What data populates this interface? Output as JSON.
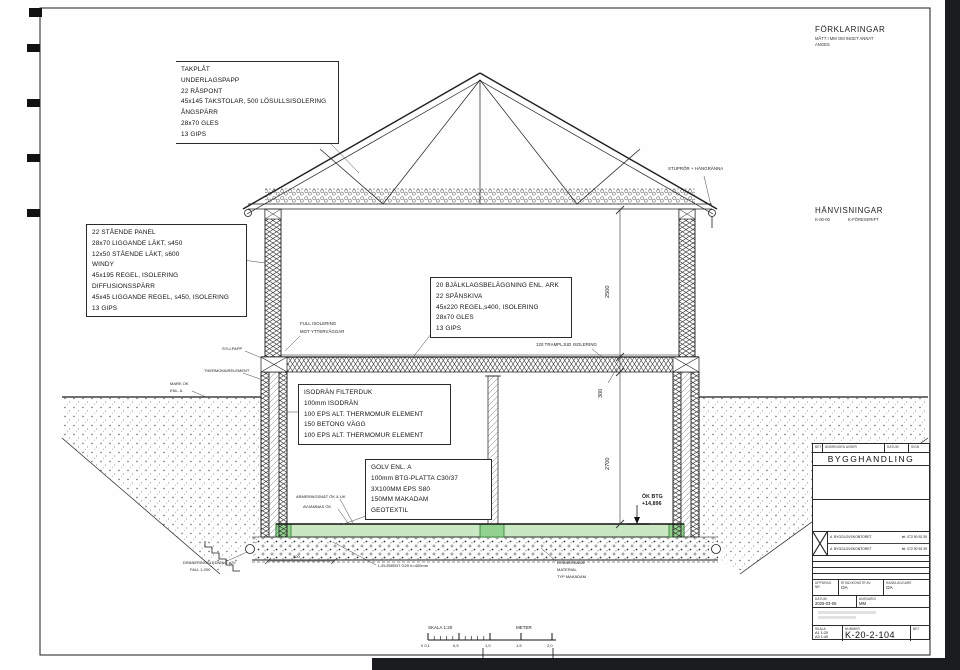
{
  "sheet": {
    "bg": "#fefefe",
    "frame_color": "#1d1d1d",
    "outside_color": "#1b1c20",
    "slab_green": "#c9e7c2",
    "slab_green_dark": "#93d18e"
  },
  "legend": {
    "title": "FÖRKLARINGAR",
    "notes": [
      "MÅTT I MM OM INGET ANNAT",
      "ANGES"
    ]
  },
  "references": {
    "title": "HÄNVISNINGAR",
    "code": "K-00-00",
    "doc": "K-FÖRESKRIFT"
  },
  "callouts": {
    "roof": {
      "lines": [
        "TAKPLÅT",
        "UNDERLAGSPAPP",
        "22 RÅSPONT",
        "45x145 TAKSTOLAR, 500 LÖSULLSISOLERING",
        "ÅNGSPÄRR",
        "28x70 GLES",
        "13 GIPS"
      ]
    },
    "exterior_wall": {
      "lines": [
        "22 STÅENDE PANEL",
        "28x70 LIGGANDE LÄKT, s450",
        "12x50 STÅENDE LÄKT, s600",
        "WINDY",
        "45x195 REGEL, ISOLERING",
        "DIFFUSIONSSPÄRR",
        "45x45 LIGGANDE REGEL, s450, ISOLERING",
        "13 GIPS"
      ]
    },
    "intermediate_floor": {
      "lines": [
        "20 BJÄLKLAGSBELÄGGNING ENL. ARK",
        "22 SPÅNSKIVA",
        "45x220 REGEL,s400, ISOLERING",
        "28x70 GLES",
        "13 GIPS"
      ]
    },
    "basement_wall": {
      "lines": [
        "ISODRÄN FILTERDUK",
        "100mm ISODRÄN",
        "100 EPS ALT. THERMOMUR ELEMENT",
        "150 BETONG VÄGG",
        "100 EPS ALT. THERMOMUR ELEMENT"
      ]
    },
    "floor_slab": {
      "lines": [
        "GOLV ENL. A",
        "100mm BTG-PLATTA C30/37",
        "3X100MM EPS S80",
        "150MM MAKADAM",
        "GEOTEXTIL"
      ]
    },
    "gutter": "STUPRÖR + HÄNGRÄNNA",
    "full_insulation": [
      "FULL ISOLERING",
      "MOT YTTERVÄGGAR"
    ],
    "impact_insulation": "120 TRAMPLJUD ISOLERING",
    "sill": "SYLLPAPP",
    "thermomur": "THERMOMURELEMENT",
    "ground_level": [
      "MARK OK",
      "ENL. A"
    ],
    "top_of_concrete": [
      "ÖK BTG",
      "+14,896"
    ],
    "drainage_pipe": [
      "DRÄNERINGSLEDNING ø70",
      "FALL 1:200"
    ],
    "l_element": "L-ELEMENT G20 h=400mm",
    "dim_500": "500",
    "draining_material": [
      "DRÄNERANDE",
      "MATERIAL",
      "TYP MAKADAM"
    ],
    "reinforcement": "ARMERINGSNÄT ÖK & UK",
    "leveling": "AVJÄMNAS ÖK"
  },
  "dimensions": {
    "upper_room": "2500",
    "floor": "300",
    "basement": "2700"
  },
  "scalebar": {
    "title": "SKALA 1:20",
    "unit": "METER",
    "ticks": [
      "0 0,1",
      "0,5",
      "1,0",
      "1,5",
      "2,0"
    ]
  },
  "titleblock": {
    "revision_headers": [
      "BET",
      "ÄNDRINGEN AVSER",
      "DATUM",
      "SIGN"
    ],
    "status": "BYGGHANDLING",
    "contacts": [
      {
        "mark": "A",
        "name": "BYGGLOVSKONTORET",
        "tel": "tel. 072 90 92 39"
      },
      {
        "mark": "A",
        "name": "BYGGLOVSKONTORET",
        "tel": "tel. 072 90 92 39"
      }
    ],
    "field_labels": {
      "project_no": "UPPDRAG NR",
      "drawn_by": "RITAD/KONSTR AV",
      "handler": "HANDLÄGGARE",
      "date": "DATUM",
      "responsible": "ANSVARIG",
      "scale": "SKALA",
      "number": "NUMMER",
      "revision": "BET"
    },
    "drawn_by": "OA",
    "handler": "OA",
    "date": "2025-03-06",
    "responsible": "MM",
    "scales": [
      "A1 1:20",
      "A3 1:40"
    ],
    "number": "K-20-2-104"
  }
}
